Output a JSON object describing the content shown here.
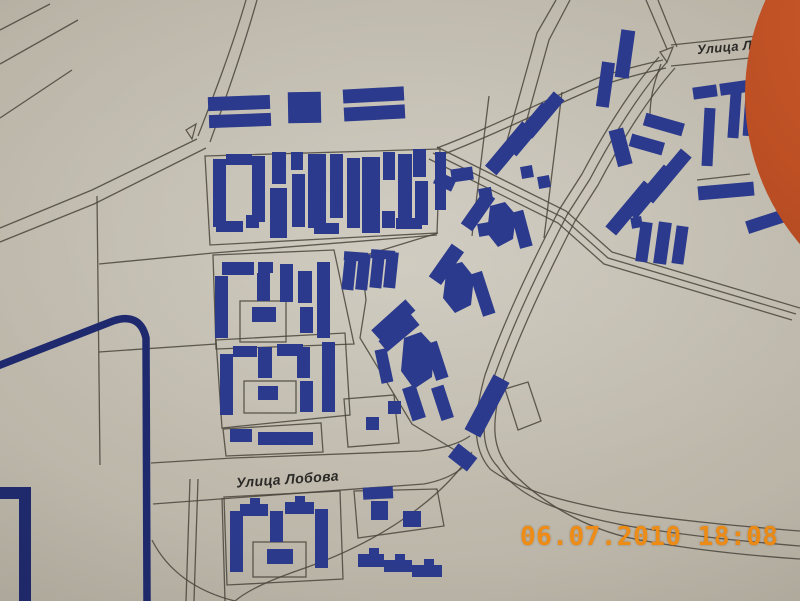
{
  "labels": {
    "street_main": "Улица Лобова",
    "street_top_right": "Улица Лоб"
  },
  "timestamp": "06.07.2010 18:08",
  "colors": {
    "paper_light": "#c9c4b7",
    "paper_mid": "#b7b1a4",
    "paper_dark": "#a19a8c",
    "building": "#2b3a8c",
    "boundary": "#1f2a6e",
    "road": "#4a453c",
    "marker": "#bd4f24",
    "timestamp": "#ee8c15",
    "label_text": "#2b2a27"
  }
}
